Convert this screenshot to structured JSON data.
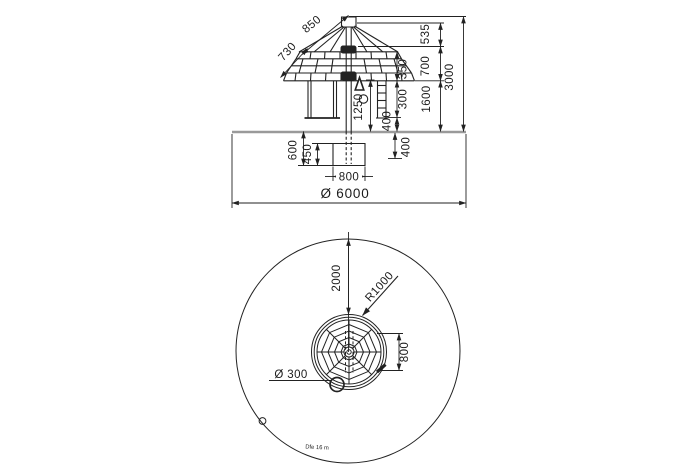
{
  "drawing": {
    "elevation": {
      "dim_850": "850",
      "dim_730": "730",
      "dim_535": "535",
      "dim_700": "700",
      "dim_3000": "3000",
      "dim_350": "350",
      "dim_300": "300",
      "dim_1600": "1600",
      "dim_1250": "1250",
      "dim_400_ladder": "400",
      "dim_400_depth": "400",
      "dim_600": "600",
      "dim_450": "450",
      "dim_800": "800",
      "dim_diameter": "Ø 6000"
    },
    "plan": {
      "dim_2000": "2000",
      "dim_radius": "R1000",
      "dim_800": "800",
      "dim_small_circle": "Ø 300",
      "note": "Dfe 16 m"
    },
    "colors": {
      "line": "#222222",
      "ground": "#9a9a9a",
      "background": "#ffffff"
    }
  }
}
